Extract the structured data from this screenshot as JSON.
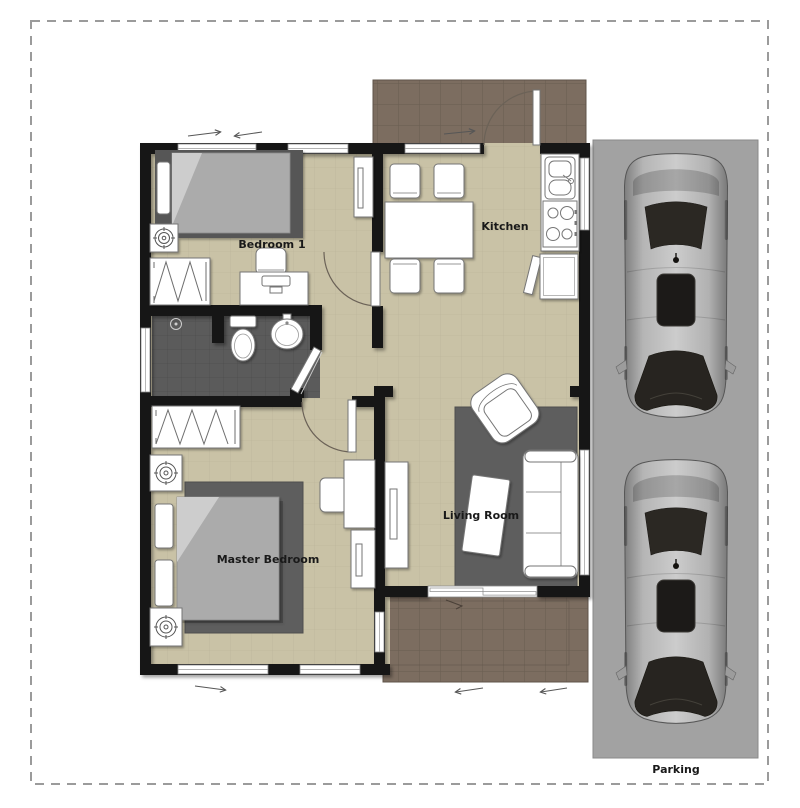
{
  "rooms": {
    "bedroom1": {
      "label": "Bedroom 1"
    },
    "kitchen": {
      "label": "Kitchen"
    },
    "master_bedroom": {
      "label": "Master Bedroom"
    },
    "living_room": {
      "label": "Living Room"
    },
    "parking": {
      "label": "Parking"
    }
  },
  "colors": {
    "wall": "#171513",
    "floor": "#c9c2a6",
    "floor_grid": "#b9b297",
    "patio": "#7c6d60",
    "patio_grid": "#695d51",
    "bathroom_floor": "#5b5b5b",
    "bathroom_grid": "#4d4d4d",
    "rug": "#5e5e5e",
    "parking_ground": "#a2a2a2",
    "boundary": "#9b9b9b",
    "furniture": "#ffffff",
    "furniture_line": "#757575",
    "bed_mattress": "#ababab",
    "bed_base": "#565656",
    "label": "#191919",
    "glass_dark": "#2b2823"
  }
}
